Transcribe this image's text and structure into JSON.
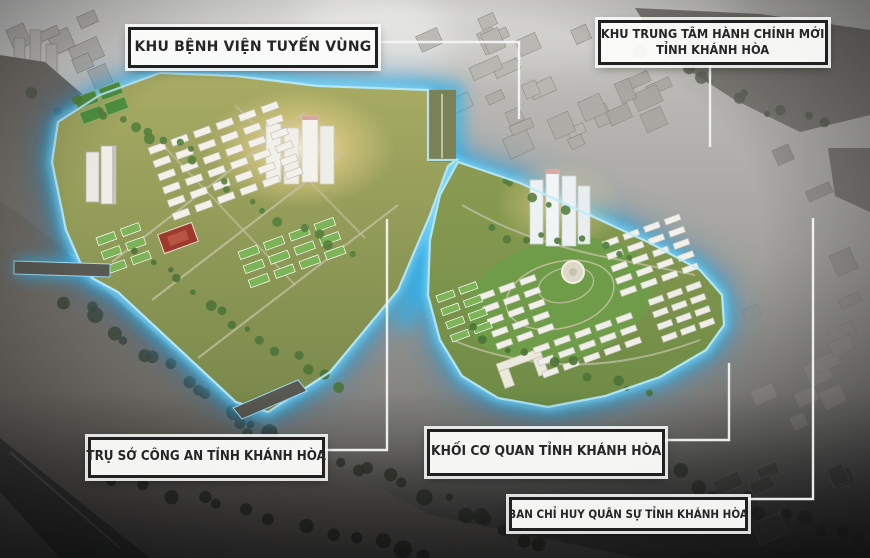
{
  "labels": [
    {
      "id": "regional-hospital",
      "text": "KHU BỆNH VIỆN TUYẾN VÙNG"
    },
    {
      "id": "new-admin-center",
      "line1": "KHU TRUNG TÂM HÀNH CHÍNH MỚI",
      "line2": "TỈNH KHÁNH HÒA"
    },
    {
      "id": "police-hq",
      "text": "TRỤ SỞ CÔNG AN TỈNH KHÁNH HÒA"
    },
    {
      "id": "provincial-agency-block",
      "text": "KHỐI CƠ QUAN TỈNH KHÁNH HÒA"
    },
    {
      "id": "military-command",
      "text": "BAN CHỈ HUY QUÂN SỰ TỈNH KHÁNH HÒA"
    }
  ],
  "colors": {
    "site_glow": "#38c0f5",
    "site_glow_rim": "#b8ecff",
    "label_border": "#202020",
    "label_background": "#fcfcfb",
    "label_text": "#262626",
    "leader_line": "#f4f4f4"
  }
}
